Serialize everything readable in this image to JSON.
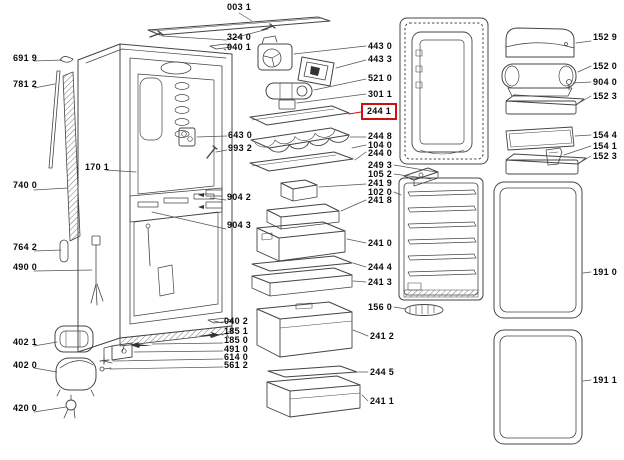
{
  "diagram": {
    "kind": "refrigerator exploded spare-parts diagram",
    "background": "#ffffff",
    "line_color": "#444444",
    "highlight": {
      "selected_part": "244 1",
      "box_color": "#cc1111"
    }
  },
  "labels": {
    "l003_1": "003 1",
    "l324_0": "324 0",
    "l040_1": "040 1",
    "l691_9": "691 9",
    "l781_2": "781 2",
    "l170_1": "170 1",
    "l740_0": "740 0",
    "l764_2": "764 2",
    "l490_0": "490 0",
    "l402_1": "402 1",
    "l402_0": "402 0",
    "l420_0": "420 0",
    "l643_0": "643 0",
    "l993_2": "993 2",
    "l904_2": "904 2",
    "l904_3": "904 3",
    "l040_2": "040 2",
    "l185_1": "185 1",
    "l185_0": "185 0",
    "l491_0": "491 0",
    "l614_0": "614 0",
    "l561_2": "561 2",
    "l443_0": "443 0",
    "l443_3": "443 3",
    "l521_0": "521 0",
    "l301_1": "301 1",
    "l244_1": "244 1",
    "l244_8": "244 8",
    "l104_0": "104 0",
    "l244_0": "244 0",
    "l249_3": "249 3",
    "l105_2": "105 2",
    "l241_9": "241 9",
    "l102_0": "102 0",
    "l241_8": "241 8",
    "l241_0": "241 0",
    "l244_4": "244 4",
    "l241_3": "241 3",
    "l156_0": "156 0",
    "l241_2": "241 2",
    "l244_5": "244 5",
    "l241_1": "241 1",
    "l152_9": "152 9",
    "l152_0": "152 0",
    "l904_0": "904 0",
    "l152_3a": "152 3",
    "l154_4": "154 4",
    "l154_1": "154 1",
    "l152_3b": "152 3",
    "l191_0": "191 0",
    "l191_1": "191 1"
  }
}
